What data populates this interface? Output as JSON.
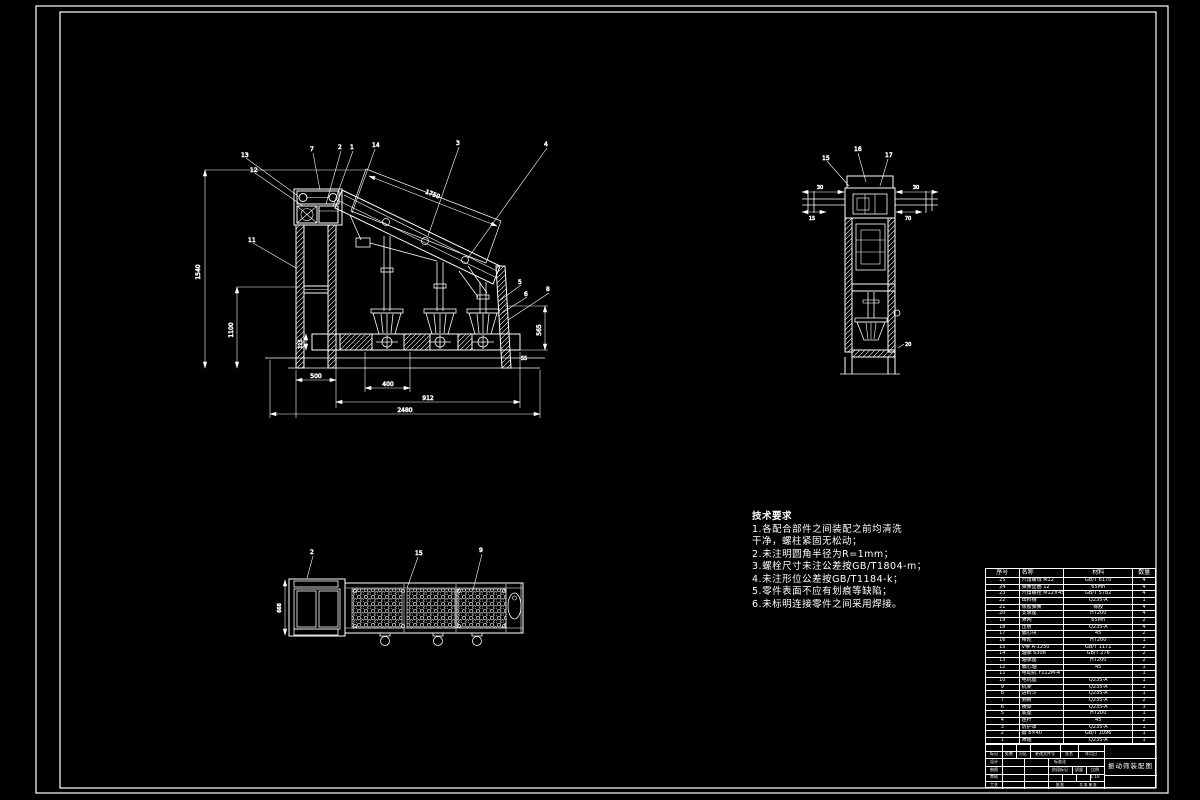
{
  "page": {
    "background": "#000000",
    "line_color": "#ffffff"
  },
  "tech_requirements": {
    "title": "技术要求",
    "lines": [
      "1.各配合部件之间装配之前均清洗",
      "干净，螺柱紧固无松动；",
      "2.未注明圆角半径为R=1mm；",
      "3.螺栓尺寸未注公差按GB/T1804-m；",
      "4.未注形位公差按GB/T1184-k；",
      "5.零件表面不应有划痕等缺陷；",
      "6.未标明连接零件之间采用焊接。"
    ]
  },
  "parts_table": {
    "headers": [
      "序号",
      "名称",
      "材料",
      "数量"
    ],
    "rows": [
      [
        "25",
        "六角螺母 M12",
        "GB/T 6170",
        "4"
      ],
      [
        "24",
        "弹簧垫圈 12",
        "65Mn",
        "4"
      ],
      [
        "23",
        "六角螺栓 M12×45",
        "GB/T 5782",
        "4"
      ],
      [
        "22",
        "出料槽",
        "Q235-A",
        "1"
      ],
      [
        "21",
        "橡胶弹簧",
        "橡胶",
        "4"
      ],
      [
        "20",
        "支承座",
        "HT200",
        "4"
      ],
      [
        "19",
        "筛网",
        "65Mn",
        "2"
      ],
      [
        "18",
        "压板",
        "Q235-A",
        "4"
      ],
      [
        "17",
        "偏心块",
        "45",
        "2"
      ],
      [
        "16",
        "带轮",
        "HT200",
        "1"
      ],
      [
        "15",
        "V带 A-1250",
        "GB/T 1171",
        "2"
      ],
      [
        "14",
        "轴承 6308",
        "GB/T 276",
        "2"
      ],
      [
        "13",
        "轴承座",
        "HT200",
        "2"
      ],
      [
        "12",
        "偏心轴",
        "45",
        "1"
      ],
      [
        "11",
        "电动机 Y112M-4",
        "",
        "1"
      ],
      [
        "10",
        "电机座",
        "Q235-A",
        "1"
      ],
      [
        "9",
        "机架",
        "Q235-A",
        "1"
      ],
      [
        "8",
        "进料斗",
        "Q235-A",
        "1"
      ],
      [
        "7",
        "侧板",
        "Q235-A",
        "2"
      ],
      [
        "6",
        "横梁",
        "Q235-A",
        "3"
      ],
      [
        "5",
        "底座",
        "HT200",
        "1"
      ],
      [
        "4",
        "连杆",
        "45",
        "2"
      ],
      [
        "3",
        "防护罩",
        "Q235-A",
        "1"
      ],
      [
        "2",
        "键 8×40",
        "GB/T 1096",
        "1"
      ],
      [
        "1",
        "筛箱",
        "Q235-A",
        "1"
      ]
    ]
  },
  "title_block": {
    "title": "振动筛装配图",
    "mark": "标记",
    "count": "处数",
    "zone": "分区",
    "change_doc": "更改文件号",
    "sign": "签名",
    "date": "年月日",
    "design": "设计",
    "draft": "制图",
    "check": "审核",
    "process": "工艺",
    "standard": "标准化",
    "stage": "阶段标记",
    "mass": "质量",
    "scale": "比例",
    "approve": "批准",
    "sheet": "共 张 第 张",
    "scale_value": "1:10"
  },
  "dims": {
    "left_outer": "1540",
    "left_inner": "1100",
    "bottom1": "500",
    "bottom2": "400",
    "bottom3": "912",
    "bottom4": "2480",
    "incline": "1750",
    "right_v": "565",
    "right_s": "55",
    "band": "115",
    "sv_left1": "30",
    "sv_left2": "15",
    "sv_right1": "30",
    "sv_right2": "70",
    "sv_foot": "20",
    "plan_left": "668"
  },
  "callouts": {
    "m13": "13",
    "m12": "12",
    "m7": "7",
    "m2": "2",
    "m1": "1",
    "m14": "14",
    "m3": "3",
    "m4": "4",
    "m11": "11",
    "m5": "5",
    "m6": "6",
    "m8": "8",
    "s15": "15",
    "s16": "16",
    "s17": "17",
    "p1": "2",
    "p2": "15",
    "p3": "9"
  }
}
